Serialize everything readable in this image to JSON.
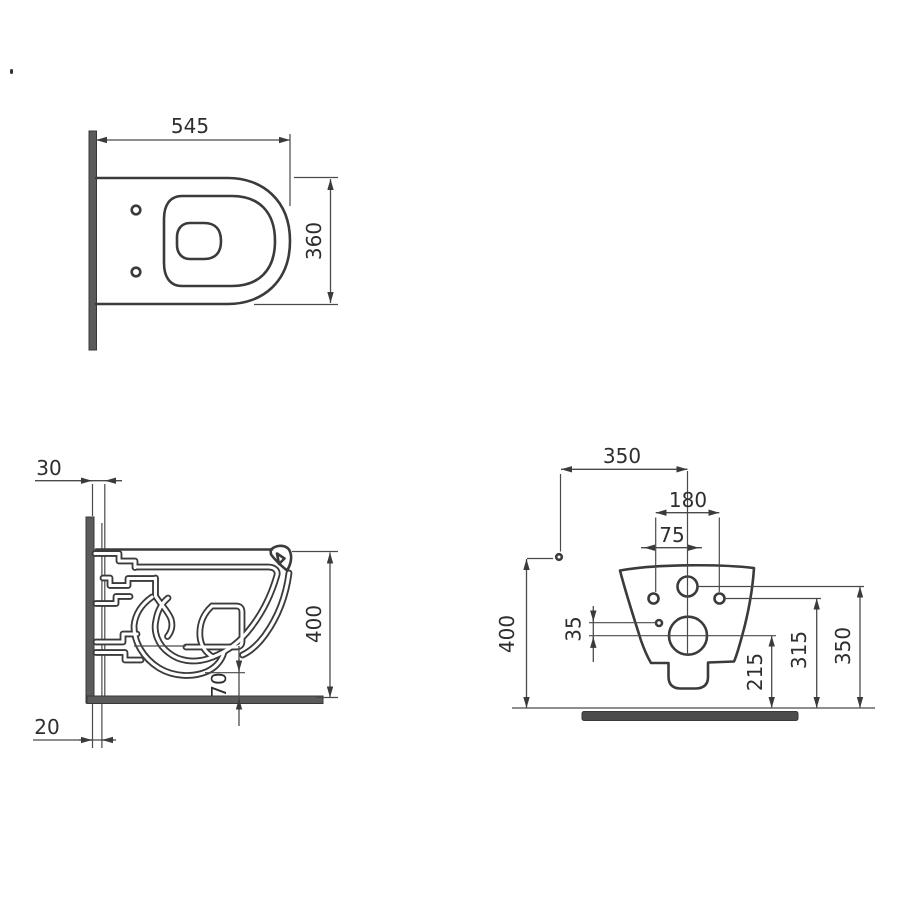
{
  "drawing_title": "wall-hung-toilet-technical-drawing",
  "colors": {
    "line": "#3b3b3b",
    "dim": "#4a4a4a",
    "text": "#2e2e2e",
    "wall": "#5b5b5b",
    "slab": "#4c4c4c"
  },
  "views": {
    "top": {
      "label": "top-view-plan",
      "dims": {
        "width": "545",
        "depth": "360"
      }
    },
    "side": {
      "label": "side-view-section",
      "dims": {
        "wall_gap_top": "30",
        "wall_gap_bottom": "20",
        "height": "400",
        "outlet_height": "70"
      }
    },
    "rear": {
      "label": "rear-view",
      "dims": {
        "wall_to_axis": "350",
        "bolt_spacing": "180",
        "bolt_to_axis": "75",
        "height": "400",
        "hole_gap": "35",
        "outlet_axis_height": "215",
        "bolt_height": "315",
        "inlet_height": "350"
      }
    }
  }
}
